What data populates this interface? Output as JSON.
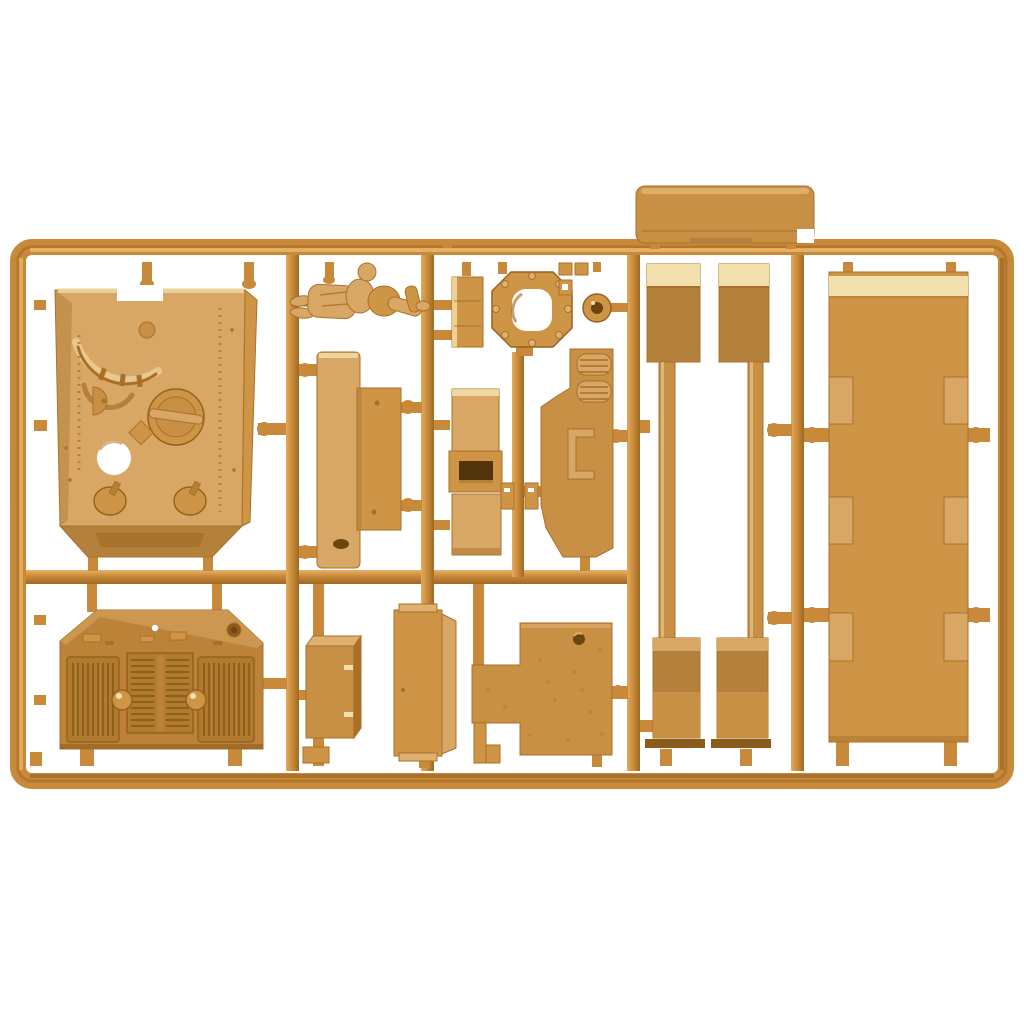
{
  "subject": "Tan injection-molded plastic model-kit sprue with tank parts photographed on a white background",
  "palette": {
    "background": "#ffffff",
    "frame": "#c9893a",
    "frame_highlight": "#e7b267",
    "frame_shadow": "#9c6a20",
    "part_base": "#d9a765",
    "part_mid": "#cf9547",
    "part_tan": "#c79045",
    "part_deep": "#b3813b",
    "part_dark": "#a87127",
    "part_shadow": "#8a5a1a",
    "cream_band": "#f2e0ac",
    "slot_dark": "#52350c",
    "hole_dark": "#6b4410"
  },
  "parts": [
    {
      "id": "sprue-frame",
      "label": "sprue frame and runners"
    },
    {
      "id": "turret-roof-panel",
      "label": "turret roof panel with circular hatch"
    },
    {
      "id": "crew-figure",
      "label": "tank crew figure"
    },
    {
      "id": "hinge-plate",
      "label": "small hinge plate"
    },
    {
      "id": "hatch-ring",
      "label": "octagonal hatch ring"
    },
    {
      "id": "periscope-ring",
      "label": "round periscope ring"
    },
    {
      "id": "detail-clips",
      "label": "small detail clips"
    },
    {
      "id": "roof-plate",
      "label": "long roof plate above frame"
    },
    {
      "id": "fender-strip-left",
      "label": "left fender strip"
    },
    {
      "id": "fender-strip-right",
      "label": "right fender strip"
    },
    {
      "id": "hull-floor-panel",
      "label": "large hull floor panel with tabs"
    },
    {
      "id": "mudguard-plate-rear",
      "label": "tall mudguard plate"
    },
    {
      "id": "mudguard-plate-front",
      "label": "overlapping mudguard plate"
    },
    {
      "id": "hatch-plate-stack",
      "label": "stacked hatch plates with slot"
    },
    {
      "id": "hull-side-panel",
      "label": "hull side panel with vents"
    },
    {
      "id": "engine-deck-panel",
      "label": "engine deck with grilles"
    },
    {
      "id": "stowage-box",
      "label": "stowage box"
    },
    {
      "id": "door-plate",
      "label": "rear door plate"
    },
    {
      "id": "deck-plate-notched",
      "label": "notched textured deck plate"
    },
    {
      "id": "small-bracket",
      "label": "small stepped bracket"
    }
  ]
}
